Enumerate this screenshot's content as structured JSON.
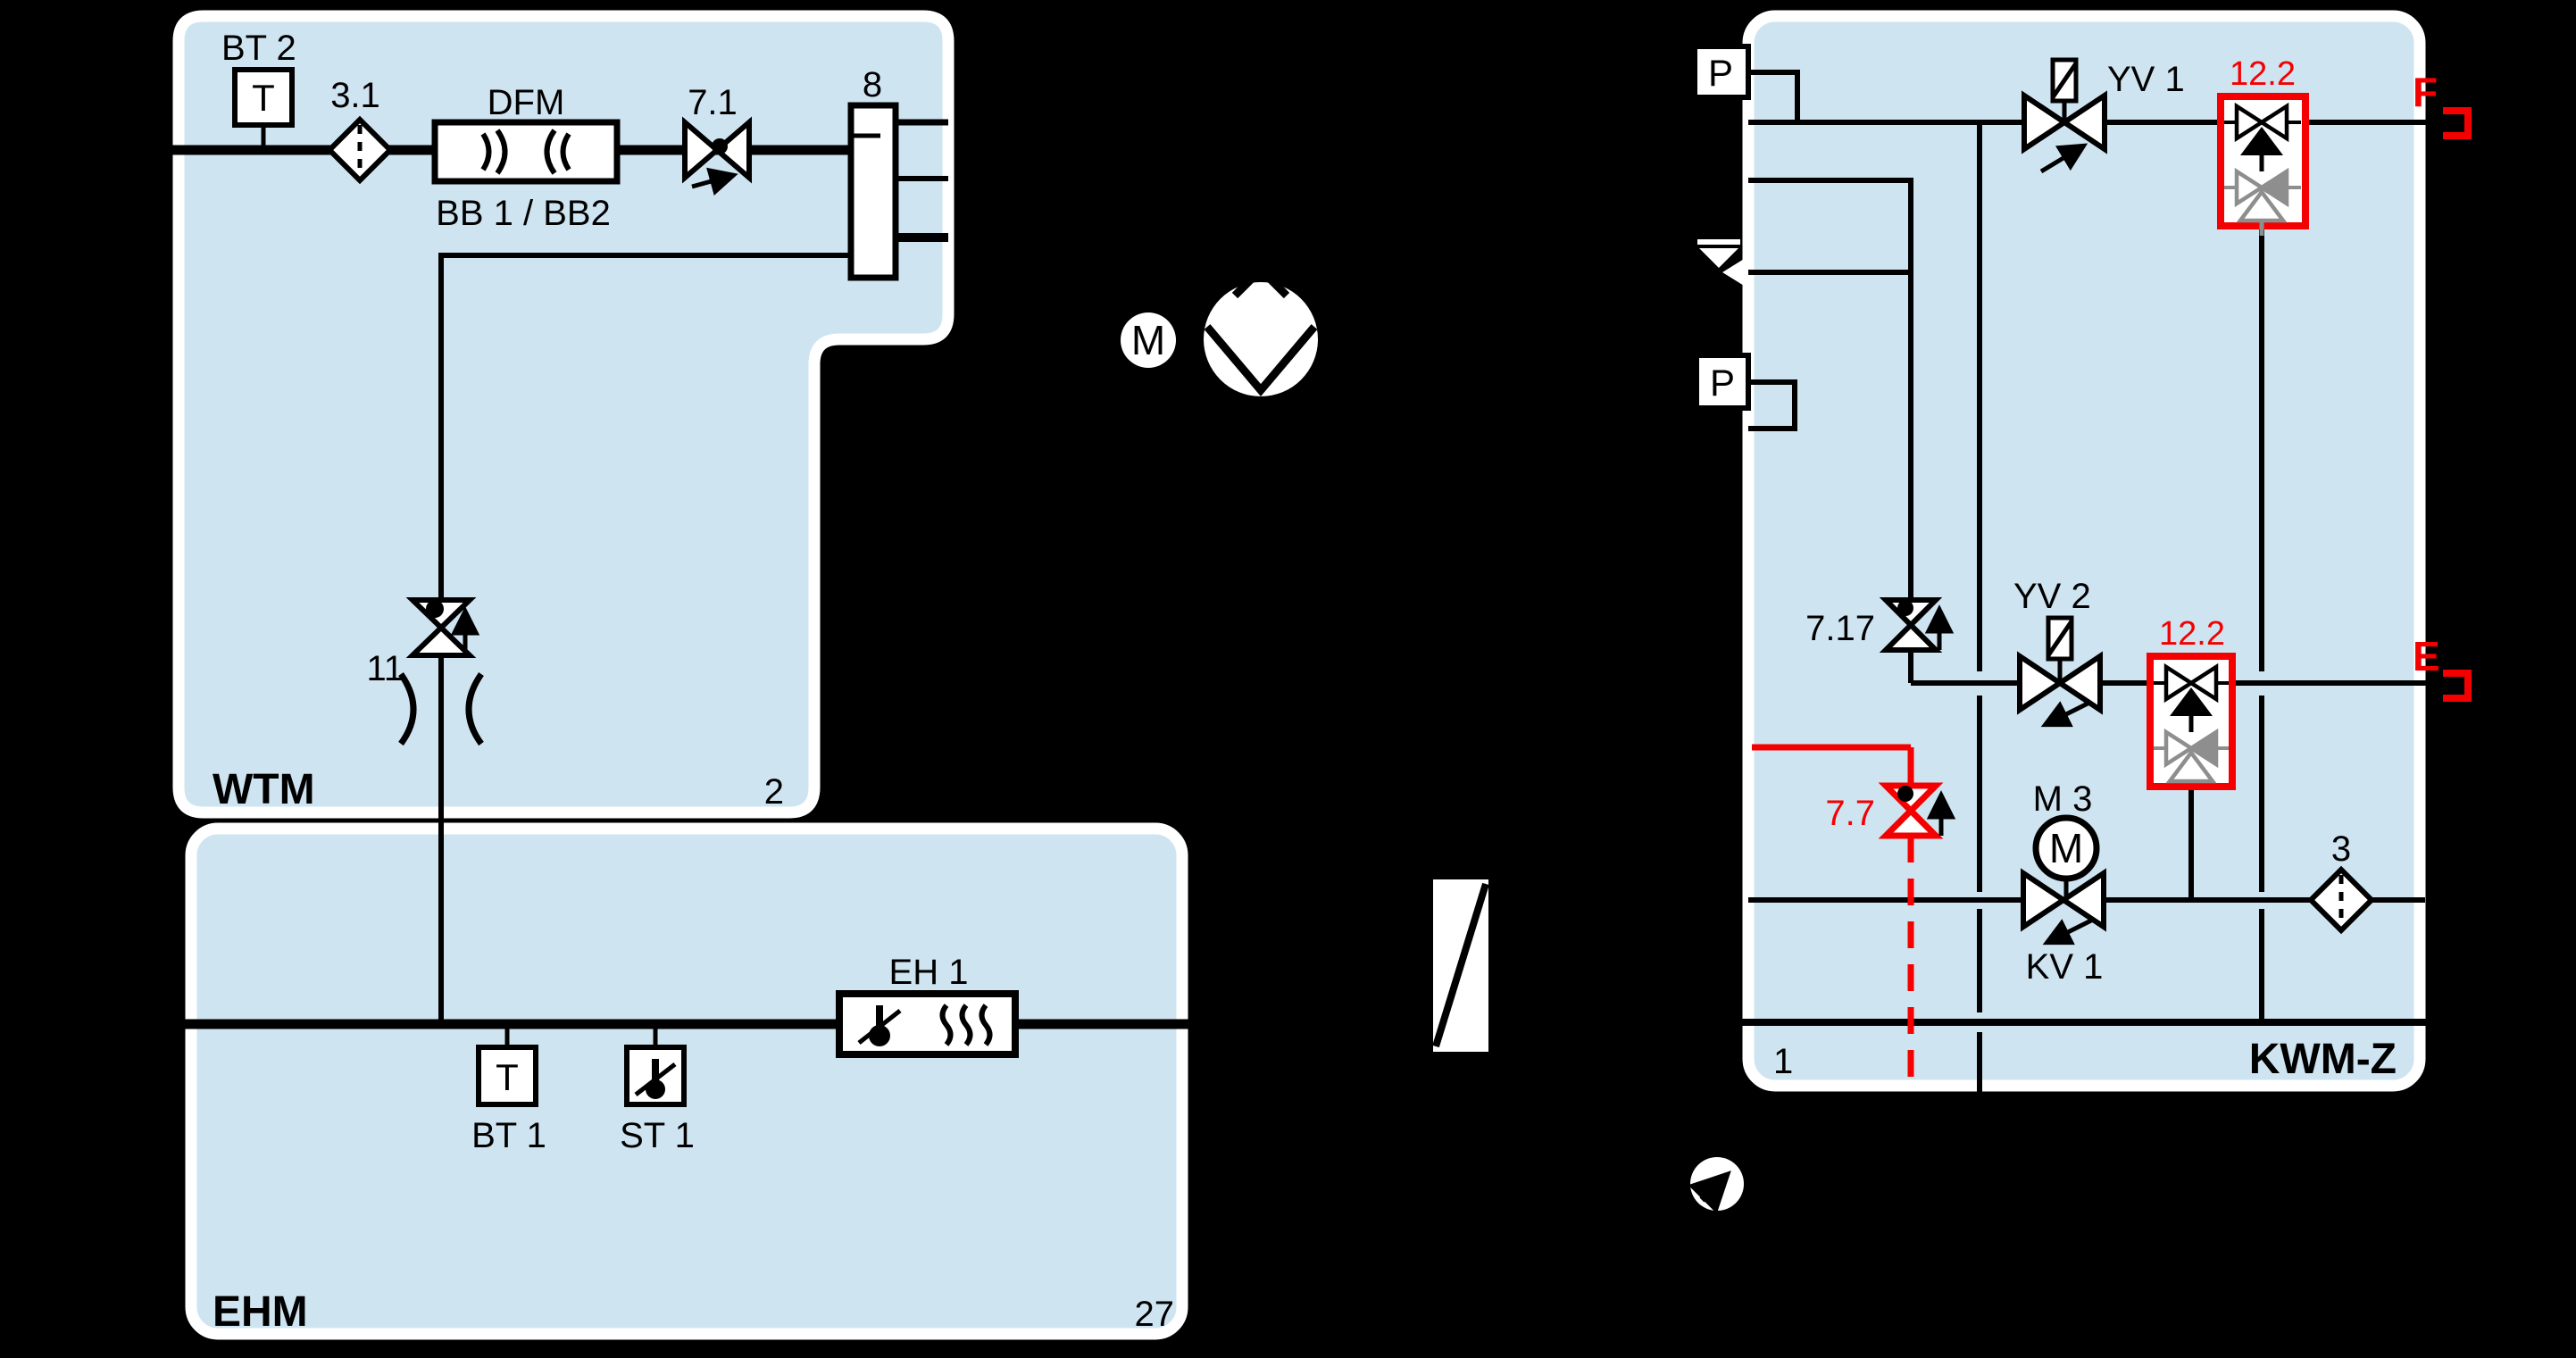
{
  "colors": {
    "background": "#000000",
    "block_fill": "#cfe4f1",
    "block_border": "#ffffff",
    "line": "#000000",
    "accent_red": "#f40000",
    "muted_gray": "#8e8e8e"
  },
  "blocks": {
    "wtm": {
      "name": "WTM",
      "number": "2"
    },
    "ehm": {
      "name": "EHM",
      "number": "27"
    },
    "kwmz": {
      "name": "KWM-Z",
      "number": "1"
    }
  },
  "components": {
    "bt2": {
      "tag": "BT 2",
      "symbol": "T"
    },
    "filter31": {
      "tag": "3.1"
    },
    "dfm": {
      "tag": "DFM",
      "subtag": "BB 1 / BB2"
    },
    "valve71": {
      "tag": "7.1"
    },
    "vessel8": {
      "tag": "8"
    },
    "valve11": {
      "tag": "11"
    },
    "pump_motor": {
      "tag": "M"
    },
    "eh1": {
      "tag": "EH 1"
    },
    "bt1": {
      "tag": "BT 1",
      "symbol": "T"
    },
    "st1": {
      "tag": "ST 1"
    },
    "pressure_top": {
      "tag": "P"
    },
    "pressure_mid": {
      "tag": "P"
    },
    "yv1": {
      "tag": "YV 1"
    },
    "backflow_top": {
      "tag": "12.2"
    },
    "valve717": {
      "tag": "7.17"
    },
    "yv2": {
      "tag": "YV 2"
    },
    "backflow_mid": {
      "tag": "12.2"
    },
    "valve77": {
      "tag": "7.7"
    },
    "m3": {
      "tag": "M 3",
      "symbol": "M"
    },
    "kv1": {
      "tag": "KV 1"
    },
    "filter3": {
      "tag": "3"
    },
    "connector_f": {
      "tag": "F"
    },
    "connector_e": {
      "tag": "E"
    }
  }
}
